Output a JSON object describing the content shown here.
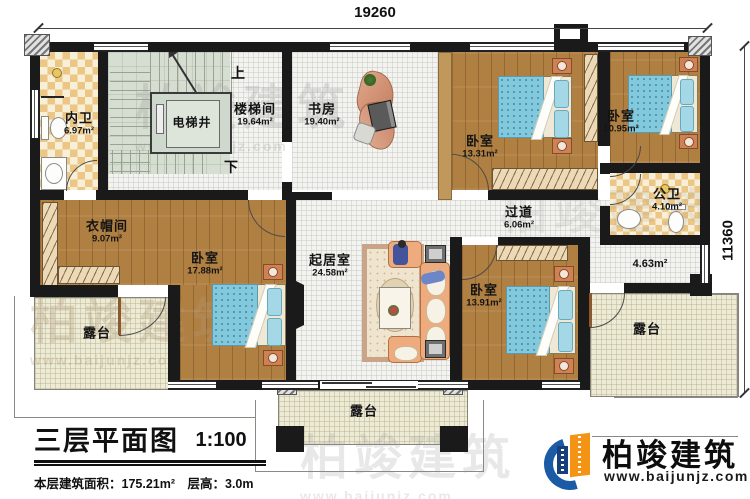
{
  "plan": {
    "dimension_top": "19260",
    "dimension_right": "11360",
    "stair_up": "上",
    "stair_down": "下",
    "rooms": [
      {
        "name": "内卫",
        "area": "6.97m²"
      },
      {
        "name": "电梯井",
        "area": ""
      },
      {
        "name": "楼梯间",
        "area": "19.64m²"
      },
      {
        "name": "书房",
        "area": "19.40m²"
      },
      {
        "name": "卧室",
        "area": "13.31m²"
      },
      {
        "name": "卧室",
        "area": "10.95m²"
      },
      {
        "name": "公卫",
        "area": "4.10m²"
      },
      {
        "name": "过道",
        "area": "6.06m²"
      },
      {
        "name": "衣帽间",
        "area": "9.07m²"
      },
      {
        "name": "卧室",
        "area": "17.88m²"
      },
      {
        "name": "起居室",
        "area": "24.58m²"
      },
      {
        "name": "卧室",
        "area": "13.91m²"
      },
      {
        "name": "",
        "area": "4.63m²"
      },
      {
        "name": "露台",
        "area": ""
      },
      {
        "name": "露台",
        "area": ""
      },
      {
        "name": "露台",
        "area": ""
      }
    ]
  },
  "title_block": {
    "title": "三层平面图",
    "scale": "1:100",
    "stats": "本层建筑面积：175.21m²　层高：3.0m",
    "note": "注：阳台算半面积，露台不算面积"
  },
  "logo": {
    "name": "柏竣建筑",
    "website": "www.baijunjz.com"
  },
  "watermark": {
    "text": "柏竣建筑",
    "url": "www.baijunjz.com"
  },
  "colors": {
    "wall": "#1a1a1a",
    "wood": "#b07f42",
    "bed": "#83c9dd",
    "terrace": "#edead6",
    "logo_blue": "#1b5aa5",
    "logo_orange": "#f59315"
  }
}
